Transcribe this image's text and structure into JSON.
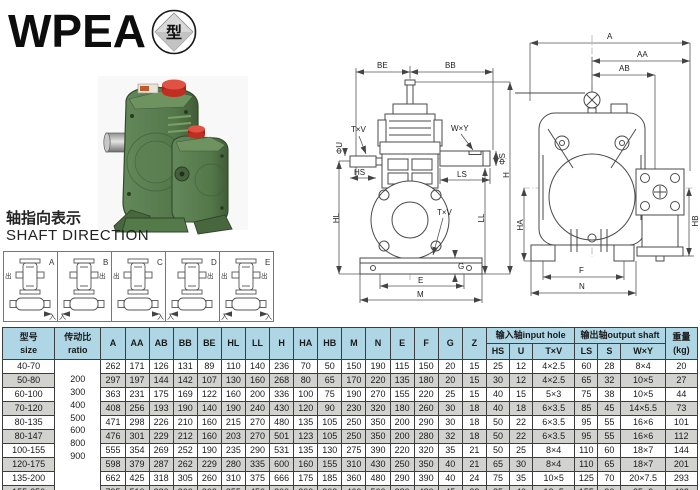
{
  "logo": {
    "title": "WPEA",
    "badge": "型"
  },
  "colors": {
    "header_bg": "#afd6e4",
    "row_alt_bg": "#d2d3cf",
    "accent_red": "#c8281e",
    "body_green": "#5a7d4e",
    "line": "#4a4a4a"
  },
  "shaft_direction": {
    "title_zh": "轴指向表示",
    "title_en": "SHAFT DIRECTION",
    "in_label": "入",
    "out_label": "出",
    "variants": [
      {
        "label": "A",
        "out_left": true,
        "out_right": false,
        "in_left": false,
        "in_right": true
      },
      {
        "label": "B",
        "out_left": false,
        "out_right": true,
        "in_left": true,
        "in_right": false
      },
      {
        "label": "C",
        "out_left": true,
        "out_right": false,
        "in_left": false,
        "in_right": true
      },
      {
        "label": "D",
        "out_left": false,
        "out_right": true,
        "in_left": true,
        "in_right": false
      },
      {
        "label": "E",
        "out_left": true,
        "out_right": true,
        "in_left": true,
        "in_right": true
      }
    ]
  },
  "drawings": {
    "front": {
      "labels": {
        "be": "BE",
        "bb": "BB",
        "wxy": "W×Y",
        "phis": "ΦS",
        "ls": "LS",
        "txv": "T×V",
        "phiu": "ΦU",
        "hs": "HS",
        "hl": "HL",
        "ll": "LL",
        "h": "H",
        "txv2": "T×V",
        "g": "G",
        "e": "E",
        "m": "M"
      }
    },
    "side": {
      "labels": {
        "a": "A",
        "aa": "AA",
        "ab": "AB",
        "ha": "HA",
        "hb": "HB",
        "f": "F",
        "n": "N"
      }
    }
  },
  "table": {
    "header": {
      "size_zh": "型号",
      "size_en": "size",
      "ratio_zh": "传动比",
      "ratio_en": "ratio",
      "dims": [
        "A",
        "AA",
        "AB",
        "BB",
        "BE",
        "HL",
        "LL",
        "H",
        "HA",
        "HB",
        "M",
        "N",
        "E",
        "F",
        "G",
        "Z"
      ],
      "input_group": "输入轴input hole",
      "input_cols": [
        "HS",
        "U",
        "T×V"
      ],
      "output_group": "输出轴output shaft",
      "output_cols": [
        "LS",
        "S",
        "W×Y"
      ],
      "weight_zh": "重量",
      "weight_en": "(kg)"
    },
    "ratios": [
      "200",
      "300",
      "400",
      "500",
      "600",
      "800",
      "900"
    ],
    "rows": [
      {
        "size": "40-70",
        "dims": [
          262,
          171,
          126,
          131,
          89,
          110,
          140,
          236,
          70,
          50,
          150,
          190,
          115,
          150,
          20,
          15
        ],
        "input": [
          25,
          12,
          "4×2.5"
        ],
        "output": [
          60,
          28,
          "8×4"
        ],
        "weight": 20
      },
      {
        "size": "50-80",
        "dims": [
          297,
          197,
          144,
          142,
          107,
          130,
          160,
          268,
          80,
          65,
          170,
          220,
          135,
          180,
          20,
          15
        ],
        "input": [
          30,
          12,
          "4×2.5"
        ],
        "output": [
          65,
          32,
          "10×5"
        ],
        "weight": 27
      },
      {
        "size": "60-100",
        "dims": [
          363,
          231,
          175,
          169,
          122,
          160,
          200,
          336,
          100,
          75,
          190,
          270,
          155,
          220,
          25,
          15
        ],
        "input": [
          40,
          15,
          "5×3"
        ],
        "output": [
          75,
          38,
          "10×5"
        ],
        "weight": 44
      },
      {
        "size": "70-120",
        "dims": [
          408,
          256,
          193,
          190,
          140,
          190,
          240,
          430,
          120,
          90,
          230,
          320,
          180,
          260,
          30,
          18
        ],
        "input": [
          40,
          18,
          "6×3.5"
        ],
        "output": [
          85,
          45,
          "14×5.5"
        ],
        "weight": 73
      },
      {
        "size": "80-135",
        "dims": [
          471,
          298,
          226,
          210,
          160,
          215,
          270,
          480,
          135,
          105,
          250,
          350,
          200,
          290,
          30,
          18
        ],
        "input": [
          50,
          22,
          "6×3.5"
        ],
        "output": [
          95,
          55,
          "16×6"
        ],
        "weight": 101
      },
      {
        "size": "80-147",
        "dims": [
          476,
          301,
          229,
          212,
          160,
          203,
          270,
          501,
          123,
          105,
          250,
          350,
          200,
          280,
          32,
          18
        ],
        "input": [
          50,
          22,
          "6×3.5"
        ],
        "output": [
          95,
          55,
          "16×6"
        ],
        "weight": 112
      },
      {
        "size": "100-155",
        "dims": [
          555,
          354,
          269,
          252,
          190,
          235,
          290,
          531,
          135,
          130,
          275,
          390,
          220,
          320,
          35,
          21
        ],
        "input": [
          50,
          25,
          "8×4"
        ],
        "output": [
          110,
          60,
          "18×7"
        ],
        "weight": 144
      },
      {
        "size": "120-175",
        "dims": [
          598,
          379,
          287,
          262,
          229,
          280,
          335,
          600,
          160,
          155,
          310,
          430,
          250,
          350,
          40,
          21
        ],
        "input": [
          65,
          30,
          "8×4"
        ],
        "output": [
          110,
          65,
          "18×7"
        ],
        "weight": 201
      },
      {
        "size": "135-200",
        "dims": [
          662,
          425,
          318,
          305,
          260,
          310,
          375,
          666,
          175,
          185,
          360,
          480,
          290,
          390,
          40,
          24
        ],
        "input": [
          75,
          35,
          "10×5"
        ],
        "output": [
          125,
          70,
          "20×7.5"
        ],
        "weight": 293
      },
      {
        "size": "155-250",
        "dims": [
          795,
          510,
          380,
          360,
          302,
          355,
          450,
          800,
          200,
          203,
          460,
          560,
          380,
          480,
          45,
          28
        ],
        "input": [
          85,
          40,
          "12×5"
        ],
        "output": [
          155,
          90,
          "25×9"
        ],
        "weight": 462
      }
    ]
  }
}
